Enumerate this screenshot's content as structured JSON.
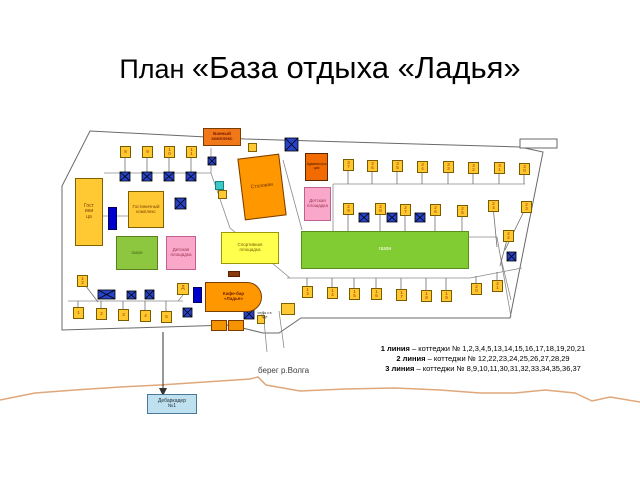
{
  "title": {
    "prefix": "План ",
    "main": "«База отдыха «Ладья»"
  },
  "plan": {
    "buildings": {
      "bath": {
        "label": "Банный\nкомплекс"
      },
      "canteen": {
        "label": "Столовая"
      },
      "admin": {
        "label": "Администрация"
      },
      "hotel": {
        "label": "Гостиница"
      },
      "hotel_complex": {
        "label": "Гостиничный комплекс"
      },
      "lawn_left": {
        "label": "газон"
      },
      "lawn_right": {
        "label": "газон"
      },
      "playground_left": {
        "label": "Детская площадка"
      },
      "playground_right": {
        "label": "Детская площадка"
      },
      "sport": {
        "label": "Спортивная\nплощадка"
      },
      "cafe": {
        "label": "Кафе-бар\n«Ладья»"
      },
      "d_block": {
        "label": "Д"
      }
    },
    "descent_label": "спуск к воде",
    "cottages": [
      {
        "n": "8",
        "x": 120,
        "y": 146,
        "sx": 125,
        "sy": 173
      },
      {
        "n": "9",
        "x": 142,
        "y": 146,
        "sx": 147,
        "sy": 173
      },
      {
        "n": "10",
        "x": 164,
        "y": 146,
        "sx": 169,
        "sy": 173
      },
      {
        "n": "11",
        "x": 186,
        "y": 146,
        "sx": 191,
        "sy": 173
      },
      {
        "n": "37",
        "x": 343,
        "y": 159,
        "sx": 348,
        "sy": 184
      },
      {
        "n": "36",
        "x": 367,
        "y": 160,
        "sx": 372,
        "sy": 184
      },
      {
        "n": "35",
        "x": 392,
        "y": 160,
        "sx": 397,
        "sy": 184
      },
      {
        "n": "34",
        "x": 417,
        "y": 161,
        "sx": 422,
        "sy": 184
      },
      {
        "n": "33",
        "x": 443,
        "y": 161,
        "sx": 448,
        "sy": 184
      },
      {
        "n": "32",
        "x": 468,
        "y": 162,
        "sx": 473,
        "sy": 184
      },
      {
        "n": "31",
        "x": 494,
        "y": 162,
        "sx": 499,
        "sy": 184
      },
      {
        "n": "30",
        "x": 519,
        "y": 163,
        "sx": 524,
        "sy": 184
      },
      {
        "n": "29",
        "x": 343,
        "y": 203,
        "sx": 348,
        "sy": 237
      },
      {
        "n": "28",
        "x": 375,
        "y": 203,
        "sx": 380,
        "sy": 237
      },
      {
        "n": "27",
        "x": 400,
        "y": 204,
        "sx": 405,
        "sy": 237
      },
      {
        "n": "26",
        "x": 430,
        "y": 204,
        "sx": 435,
        "sy": 237
      },
      {
        "n": "25",
        "x": 457,
        "y": 205,
        "sx": 462,
        "sy": 237
      },
      {
        "n": "24",
        "x": 488,
        "y": 200,
        "sx": 497,
        "sy": 247
      },
      {
        "n": "23",
        "x": 521,
        "y": 201,
        "sx": 505,
        "sy": 250
      },
      {
        "n": "22",
        "x": 503,
        "y": 230,
        "sx": 500,
        "sy": 266
      },
      {
        "n": "12",
        "x": 77,
        "y": 275,
        "sx": 98,
        "sy": 302
      },
      {
        "n": "13",
        "x": 302,
        "y": 286,
        "sx": 307,
        "sy": 278
      },
      {
        "n": "14",
        "x": 327,
        "y": 287,
        "sx": 332,
        "sy": 278
      },
      {
        "n": "15",
        "x": 349,
        "y": 288,
        "sx": 354,
        "sy": 278
      },
      {
        "n": "16",
        "x": 371,
        "y": 288,
        "sx": 376,
        "sy": 278
      },
      {
        "n": "17",
        "x": 396,
        "y": 289,
        "sx": 401,
        "sy": 278
      },
      {
        "n": "18",
        "x": 421,
        "y": 290,
        "sx": 426,
        "sy": 278
      },
      {
        "n": "19",
        "x": 441,
        "y": 290,
        "sx": 446,
        "sy": 278
      },
      {
        "n": "20",
        "x": 471,
        "y": 283,
        "sx": 476,
        "sy": 276
      },
      {
        "n": "21",
        "x": 492,
        "y": 280,
        "sx": 497,
        "sy": 272
      },
      {
        "n": "1",
        "x": 73,
        "y": 307,
        "sx": 78,
        "sy": 301
      },
      {
        "n": "2",
        "x": 96,
        "y": 308,
        "sx": 101,
        "sy": 301
      },
      {
        "n": "3",
        "x": 118,
        "y": 309,
        "sx": 123,
        "sy": 301
      },
      {
        "n": "4",
        "x": 140,
        "y": 310,
        "sx": 145,
        "sy": 301
      },
      {
        "n": "5",
        "x": 161,
        "y": 311,
        "sx": 166,
        "sy": 301
      }
    ],
    "crosses": [
      {
        "x": 285,
        "y": 138,
        "w": 13,
        "h": 13
      },
      {
        "x": 208,
        "y": 157,
        "w": 8,
        "h": 8
      },
      {
        "x": 175,
        "y": 198,
        "w": 11,
        "h": 11
      },
      {
        "x": 120,
        "y": 172,
        "w": 10,
        "h": 9
      },
      {
        "x": 142,
        "y": 172,
        "w": 10,
        "h": 9
      },
      {
        "x": 164,
        "y": 172,
        "w": 10,
        "h": 9
      },
      {
        "x": 186,
        "y": 172,
        "w": 10,
        "h": 9
      },
      {
        "x": 359,
        "y": 213,
        "w": 10,
        "h": 9
      },
      {
        "x": 387,
        "y": 213,
        "w": 10,
        "h": 9
      },
      {
        "x": 415,
        "y": 213,
        "w": 10,
        "h": 9
      },
      {
        "x": 507,
        "y": 252,
        "w": 9,
        "h": 9
      },
      {
        "x": 98,
        "y": 290,
        "w": 17,
        "h": 9
      },
      {
        "x": 127,
        "y": 291,
        "w": 9,
        "h": 8
      },
      {
        "x": 145,
        "y": 290,
        "w": 9,
        "h": 9
      },
      {
        "x": 183,
        "y": 308,
        "w": 9,
        "h": 9
      },
      {
        "x": 244,
        "y": 309,
        "w": 10,
        "h": 10
      }
    ]
  },
  "shore": {
    "label": "берег р.Волга"
  },
  "pier": {
    "label": "Дебаркадер\n№1"
  },
  "legend": {
    "lines": [
      {
        "b": "1 линия",
        "t": " – коттеджи № 1,2,3,4,5,13,14,15,16,17,18,19,20,21"
      },
      {
        "b": "2 линия",
        "t": " – коттеджи № 12,22,23,24,25,26,27,28,29"
      },
      {
        "b": "3 линия",
        "t": " – коттеджи № 8,9,10,11,30,31,32,33,34,35,36,37"
      }
    ]
  },
  "colors": {
    "cottage": "#ffc82e",
    "cross_blue": "#2743c8",
    "building_orange": "#ff9800",
    "building_yellow": "#ffc933",
    "lawn_green": "#82cc33",
    "playground_pink": "#f9a8c9",
    "sport_yellow": "#ffff4d",
    "pier_blue": "#bfe0ef",
    "shore_tan": "#dfa77a"
  }
}
